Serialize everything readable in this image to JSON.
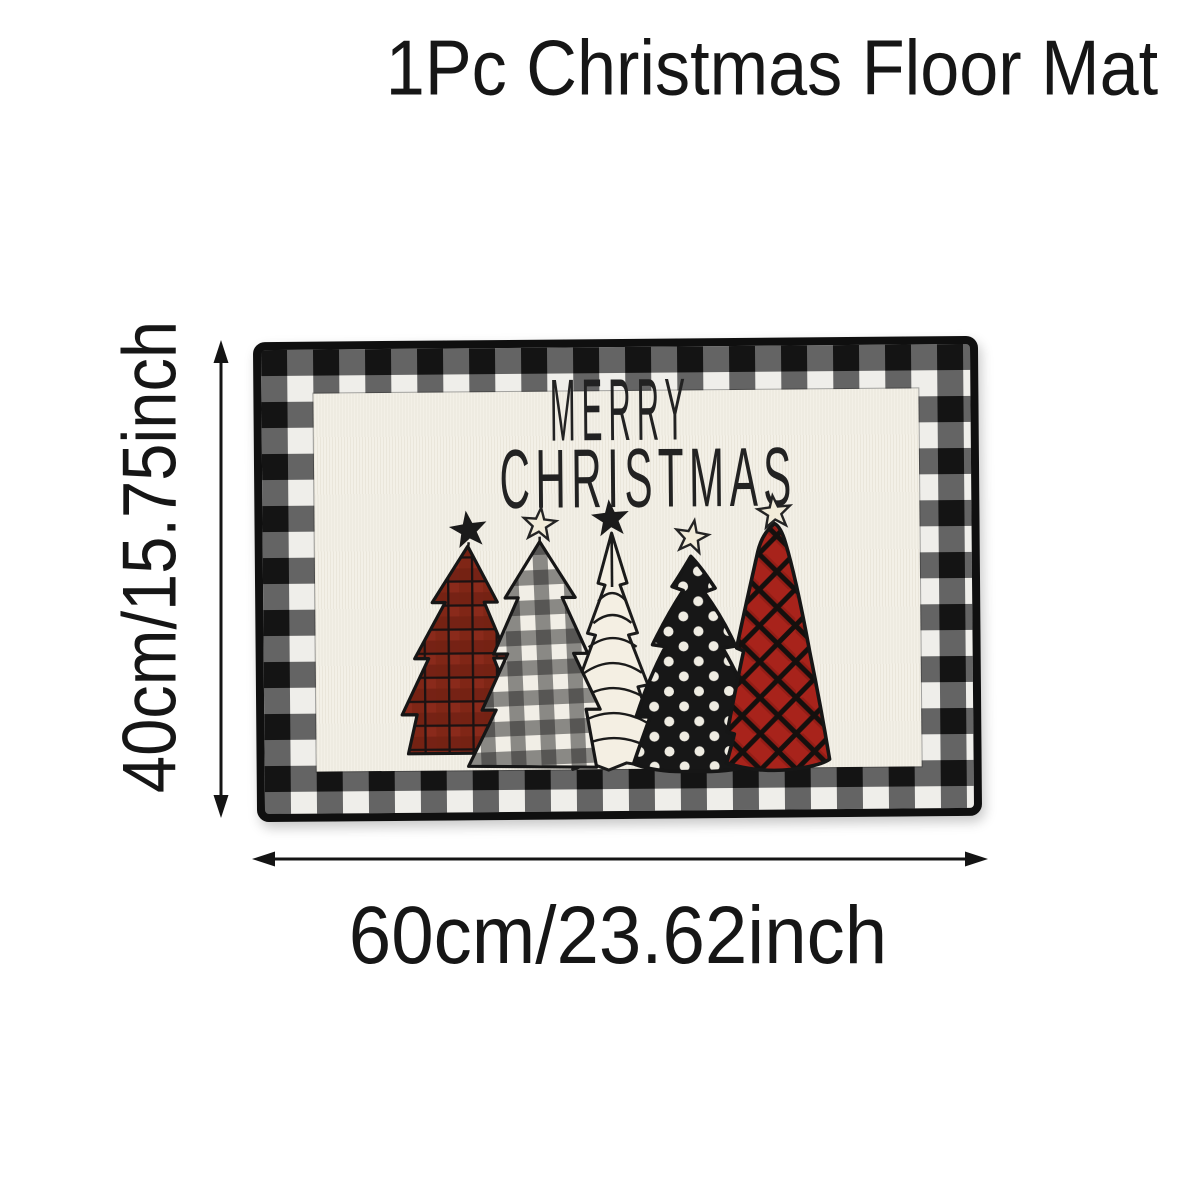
{
  "title": "1Pc Christmas Floor Mat",
  "mat": {
    "greeting_line1": "MERRY",
    "greeting_line2": "CHRISTMAS",
    "border_style": "black-white buffalo plaid with black binding",
    "trees": [
      "red-plaid-tree",
      "buffalo-check-tree",
      "white-sketch-tree",
      "black-polka-dot-tree",
      "red-lattice-tree"
    ],
    "colors": {
      "cream": "#f3f0e7",
      "plaid_black": "#141414",
      "plaid_gray": "#646464",
      "plaid_white": "#efeeea",
      "ink": "#1b1b1b",
      "tree_red_dark": "#8a2a1b",
      "tree_red_bright": "#a8231b",
      "star_cream": "#f2ecd9"
    }
  },
  "dimensions": {
    "height_label": "40cm/15.75inch",
    "width_label": "60cm/23.62inch"
  },
  "colors": {
    "page_background": "#ffffff",
    "text": "#161616"
  }
}
